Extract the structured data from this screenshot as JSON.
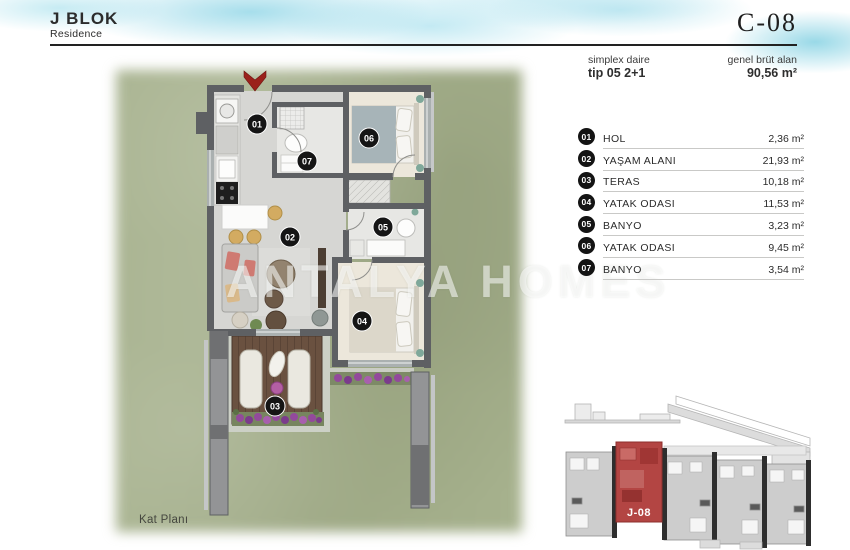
{
  "header": {
    "block_title": "J BLOK",
    "block_subtitle": "Residence",
    "unit_code": "C-08",
    "type_label": "simplex daire",
    "type_value": "tip 05 2+1",
    "area_label": "genel brüt alan",
    "area_value": "90,56 m²"
  },
  "legend": {
    "rows": [
      {
        "num": "01",
        "name": "HOL",
        "area": "2,36 m²"
      },
      {
        "num": "02",
        "name": "YAŞAM ALANI",
        "area": "21,93 m²"
      },
      {
        "num": "03",
        "name": "TERAS",
        "area": "10,18 m²"
      },
      {
        "num": "04",
        "name": "YATAK ODASI",
        "area": "11,53 m²"
      },
      {
        "num": "05",
        "name": "BANYO",
        "area": "3,23 m²"
      },
      {
        "num": "06",
        "name": "YATAK ODASI",
        "area": "9,45 m²"
      },
      {
        "num": "07",
        "name": "BANYO",
        "area": "3,54 m²"
      }
    ]
  },
  "plan": {
    "caption": "Kat Planı",
    "watermark": "ANTALYA HOMES",
    "badges": [
      "01",
      "02",
      "03",
      "04",
      "05",
      "06",
      "07"
    ]
  },
  "keyplan": {
    "unit_label": "J-08"
  },
  "colors": {
    "watercolor_blue": "#aadfe9",
    "grass_green": "#a6b18d",
    "wall_gray": "#5e6063",
    "entrance_arrow_red": "#9b211b",
    "keyplan_highlight_red": "#b34543",
    "badge_black": "#141414"
  }
}
